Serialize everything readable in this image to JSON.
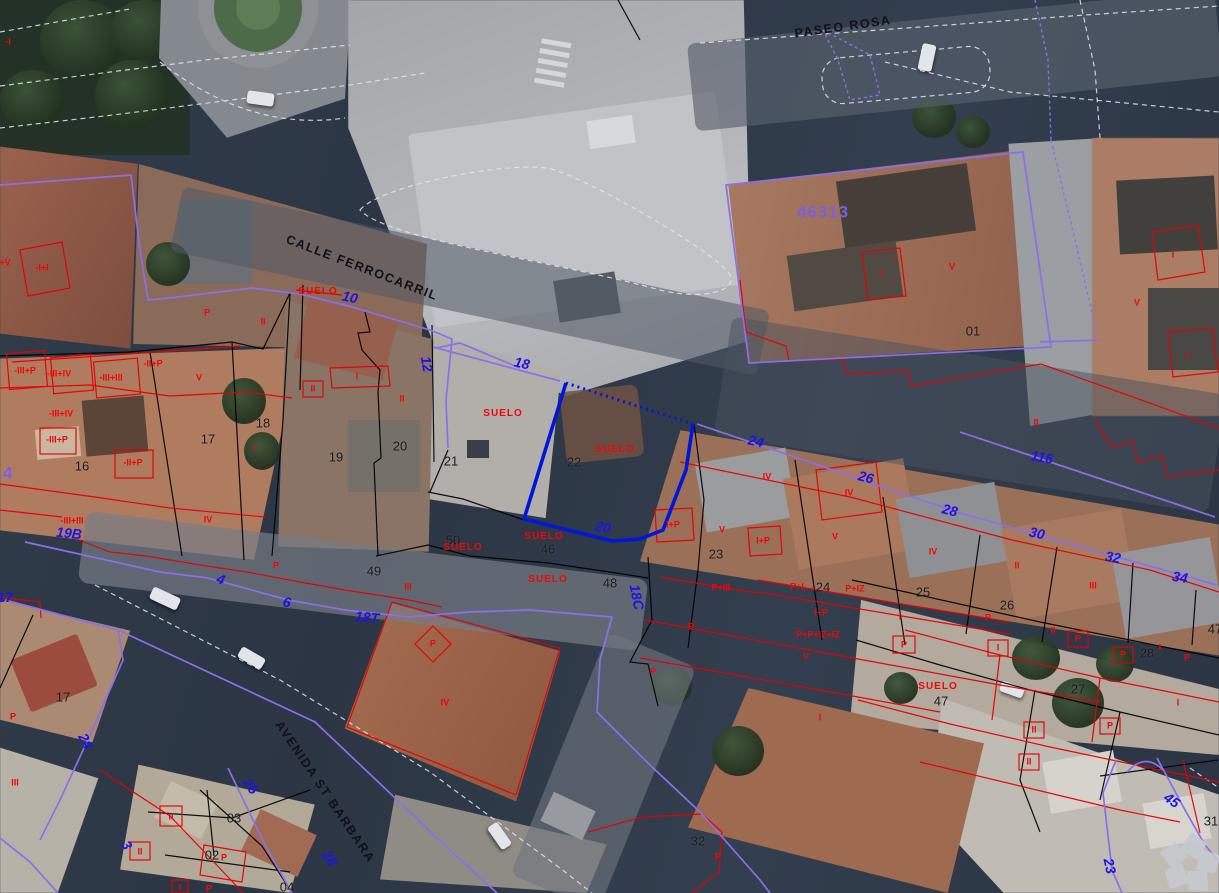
{
  "map": {
    "street_names": [
      {
        "text": "PASEO ROSA",
        "x": 843,
        "y": 27,
        "rot": -8
      },
      {
        "text": "CALLE FERROCARRIL",
        "x": 362,
        "y": 268,
        "rot": 21
      },
      {
        "text": "AVENIDA ST BARBARA",
        "x": 325,
        "y": 792,
        "rot": 56
      }
    ],
    "block_numbers": [
      {
        "text": "46313",
        "x": 823,
        "y": 212,
        "rot": 0
      },
      {
        "text": "14",
        "x": 3,
        "y": 473,
        "rot": 0
      }
    ],
    "parcel_numbers": [
      {
        "text": "16",
        "x": 82,
        "y": 466
      },
      {
        "text": "17",
        "x": 208,
        "y": 439
      },
      {
        "text": "18",
        "x": 263,
        "y": 423
      },
      {
        "text": "19",
        "x": 336,
        "y": 457
      },
      {
        "text": "20",
        "x": 400,
        "y": 446
      },
      {
        "text": "21",
        "x": 451,
        "y": 461
      },
      {
        "text": "22",
        "x": 574,
        "y": 462
      },
      {
        "text": "23",
        "x": 716,
        "y": 554
      },
      {
        "text": "24",
        "x": 823,
        "y": 587
      },
      {
        "text": "25",
        "x": 923,
        "y": 592
      },
      {
        "text": "26",
        "x": 1007,
        "y": 605
      },
      {
        "text": "27",
        "x": 1078,
        "y": 689
      },
      {
        "text": "28",
        "x": 1147,
        "y": 653
      },
      {
        "text": "01",
        "x": 973,
        "y": 331
      },
      {
        "text": "46",
        "x": 548,
        "y": 549
      },
      {
        "text": "47",
        "x": 941,
        "y": 701
      },
      {
        "text": "48",
        "x": 610,
        "y": 583
      },
      {
        "text": "49",
        "x": 374,
        "y": 571
      },
      {
        "text": "50",
        "x": 453,
        "y": 540
      },
      {
        "text": "17",
        "x": 63,
        "y": 697
      },
      {
        "text": "02",
        "x": 212,
        "y": 855
      },
      {
        "text": "03",
        "x": 234,
        "y": 818
      },
      {
        "text": "04",
        "x": 287,
        "y": 887
      },
      {
        "text": "32",
        "x": 698,
        "y": 841
      },
      {
        "text": "31",
        "x": 1211,
        "y": 821
      },
      {
        "text": "47",
        "x": 1215,
        "y": 629
      }
    ],
    "address_numbers": [
      {
        "text": "10",
        "x": 350,
        "y": 297,
        "rot": 12
      },
      {
        "text": "12",
        "x": 427,
        "y": 364,
        "rot": 80
      },
      {
        "text": "18",
        "x": 522,
        "y": 363,
        "rot": 12
      },
      {
        "text": "20",
        "x": 603,
        "y": 527,
        "rot": 10
      },
      {
        "text": "24",
        "x": 756,
        "y": 441,
        "rot": 13
      },
      {
        "text": "26",
        "x": 866,
        "y": 477,
        "rot": 14
      },
      {
        "text": "28",
        "x": 950,
        "y": 510,
        "rot": 14
      },
      {
        "text": "30",
        "x": 1037,
        "y": 533,
        "rot": 12
      },
      {
        "text": "32",
        "x": 1113,
        "y": 557,
        "rot": 10
      },
      {
        "text": "34",
        "x": 1180,
        "y": 577,
        "rot": 10
      },
      {
        "text": "116",
        "x": 1042,
        "y": 457,
        "rot": 10
      },
      {
        "text": "4",
        "x": 221,
        "y": 579,
        "rot": 20
      },
      {
        "text": "6",
        "x": 287,
        "y": 602,
        "rot": 12
      },
      {
        "text": "18T",
        "x": 367,
        "y": 617,
        "rot": 6
      },
      {
        "text": "18C",
        "x": 637,
        "y": 597,
        "rot": 78
      },
      {
        "text": "19B",
        "x": 69,
        "y": 533,
        "rot": 6
      },
      {
        "text": "24",
        "x": 86,
        "y": 741,
        "rot": 62
      },
      {
        "text": "26",
        "x": 251,
        "y": 786,
        "rot": 55
      },
      {
        "text": "3",
        "x": 127,
        "y": 845,
        "rot": 60
      },
      {
        "text": "28",
        "x": 330,
        "y": 858,
        "rot": 55
      },
      {
        "text": "45",
        "x": 1172,
        "y": 800,
        "rot": 35
      },
      {
        "text": "23",
        "x": 1110,
        "y": 866,
        "rot": 78
      },
      {
        "text": "17",
        "x": 5,
        "y": 597,
        "rot": 0
      }
    ],
    "floor_labels": [
      {
        "text": "-III+P",
        "x": 25,
        "y": 371
      },
      {
        "text": "-III+IV",
        "x": 59,
        "y": 374
      },
      {
        "text": "-III+III",
        "x": 111,
        "y": 378
      },
      {
        "text": "-II+P",
        "x": 153,
        "y": 364
      },
      {
        "text": "-III+IV",
        "x": 61,
        "y": 414
      },
      {
        "text": "-III+P",
        "x": 57,
        "y": 440
      },
      {
        "text": "-II+P",
        "x": 133,
        "y": 463
      },
      {
        "text": "-III+III",
        "x": 72,
        "y": 521
      },
      {
        "text": "V",
        "x": 199,
        "y": 378
      },
      {
        "text": "I",
        "x": 254,
        "y": 448
      },
      {
        "text": "IV",
        "x": 208,
        "y": 520
      },
      {
        "text": "P",
        "x": 207,
        "y": 313
      },
      {
        "text": "II",
        "x": 263,
        "y": 322
      },
      {
        "text": "-I+I",
        "x": 42,
        "y": 268
      },
      {
        "text": "+V",
        "x": 5,
        "y": 263
      },
      {
        "text": "-I",
        "x": 8,
        "y": 42
      },
      {
        "text": "I",
        "x": 357,
        "y": 377
      },
      {
        "text": "II",
        "x": 313,
        "y": 389
      },
      {
        "text": "II",
        "x": 402,
        "y": 399
      },
      {
        "text": "I+P",
        "x": 673,
        "y": 525
      },
      {
        "text": "I+P",
        "x": 763,
        "y": 541
      },
      {
        "text": "V",
        "x": 722,
        "y": 530
      },
      {
        "text": "V",
        "x": 835,
        "y": 537
      },
      {
        "text": "IV",
        "x": 767,
        "y": 477
      },
      {
        "text": "IV",
        "x": 849,
        "y": 493
      },
      {
        "text": "IV",
        "x": 933,
        "y": 552
      },
      {
        "text": "I+P",
        "x": 821,
        "y": 613
      },
      {
        "text": "P+III",
        "x": 721,
        "y": 588
      },
      {
        "text": "P",
        "x": 691,
        "y": 627
      },
      {
        "text": "P+I",
        "x": 797,
        "y": 587
      },
      {
        "text": "P+IZ",
        "x": 855,
        "y": 589
      },
      {
        "text": "P+P+IZ+IZ",
        "x": 818,
        "y": 635
      },
      {
        "text": "V",
        "x": 806,
        "y": 657
      },
      {
        "text": "P",
        "x": 653,
        "y": 672
      },
      {
        "text": "I",
        "x": 820,
        "y": 718
      },
      {
        "text": "II",
        "x": 1036,
        "y": 423
      },
      {
        "text": "II",
        "x": 1017,
        "y": 566
      },
      {
        "text": "III",
        "x": 1093,
        "y": 586
      },
      {
        "text": "P",
        "x": 988,
        "y": 618
      },
      {
        "text": "II",
        "x": 1053,
        "y": 631
      },
      {
        "text": "I",
        "x": 900,
        "y": 617
      },
      {
        "text": "P",
        "x": 904,
        "y": 645
      },
      {
        "text": "I",
        "x": 998,
        "y": 648
      },
      {
        "text": "P",
        "x": 1078,
        "y": 639
      },
      {
        "text": "P",
        "x": 1123,
        "y": 655
      },
      {
        "text": "I",
        "x": 1160,
        "y": 648
      },
      {
        "text": "P",
        "x": 1187,
        "y": 658
      },
      {
        "text": "I",
        "x": 1178,
        "y": 703
      },
      {
        "text": "P",
        "x": 1110,
        "y": 726
      },
      {
        "text": "II",
        "x": 1034,
        "y": 730
      },
      {
        "text": "II",
        "x": 1029,
        "y": 762
      },
      {
        "text": "P",
        "x": 276,
        "y": 566
      },
      {
        "text": "III",
        "x": 408,
        "y": 587
      },
      {
        "text": "P",
        "x": 433,
        "y": 644
      },
      {
        "text": "IV",
        "x": 445,
        "y": 703
      },
      {
        "text": "P",
        "x": 13,
        "y": 717
      },
      {
        "text": "III",
        "x": 15,
        "y": 783
      },
      {
        "text": "II",
        "x": 171,
        "y": 817
      },
      {
        "text": "II",
        "x": 140,
        "y": 852
      },
      {
        "text": "P",
        "x": 224,
        "y": 858
      },
      {
        "text": "P",
        "x": 209,
        "y": 889
      },
      {
        "text": "I",
        "x": 180,
        "y": 888
      },
      {
        "text": "P",
        "x": 718,
        "y": 857
      },
      {
        "text": "I",
        "x": 881,
        "y": 274
      },
      {
        "text": "V",
        "x": 952,
        "y": 267
      },
      {
        "text": "I",
        "x": 1173,
        "y": 255
      },
      {
        "text": "V",
        "x": 1137,
        "y": 303
      },
      {
        "text": "I",
        "x": 1188,
        "y": 356
      }
    ],
    "suelo_labels": [
      {
        "text": "SUELO",
        "x": 318,
        "y": 292
      },
      {
        "text": "SUELO",
        "x": 503,
        "y": 414
      },
      {
        "text": "SUELO",
        "x": 615,
        "y": 450
      },
      {
        "text": "SUELO",
        "x": 463,
        "y": 548
      },
      {
        "text": "SUELO",
        "x": 544,
        "y": 537
      },
      {
        "text": "SUELO",
        "x": 548,
        "y": 580
      },
      {
        "text": "SUELO",
        "x": 938,
        "y": 687
      }
    ],
    "colors": {
      "parcel_boundary": "#000000",
      "building_line": "#ee0000",
      "block_boundary": "#8a70e8",
      "selected_parcel": "#0016d8",
      "address_number_text": "#1d12e8",
      "parcel_number_text": "#1b1b1b",
      "street_name_text": "#101018",
      "block_number_text": "#7a5fe0",
      "road_guide_dash": "#e4e7ee",
      "watermark": "#c6cad0"
    },
    "watermark_icon": "recycle-icon"
  }
}
